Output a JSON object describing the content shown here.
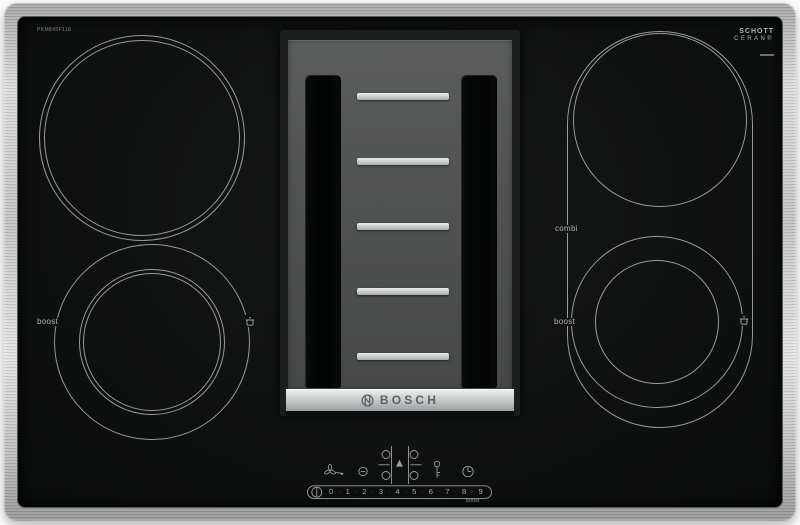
{
  "device": {
    "model_label": "PKM845F11E"
  },
  "branding": {
    "bosch_wordmark": "BOSCH",
    "glass_brand_line1": "SCHOTT",
    "glass_brand_line2": "CERAN®"
  },
  "zone_labels": {
    "left_boost": "boost",
    "combi": "combi",
    "right_boost": "boost"
  },
  "controls": {
    "power_levels": [
      "0",
      "1",
      "2",
      "3",
      "4",
      "5",
      "6",
      "7",
      "8",
      "9"
    ],
    "level_separator": "·",
    "boost_label": "boost",
    "icon_names": [
      "fan-icon",
      "vent-level-icon",
      "zone-select-icon",
      "child-lock-icon",
      "timer-icon",
      "power-icon",
      "pan-marker-icon",
      "bosch-anchor-icon"
    ]
  },
  "colors": {
    "frame_steel": "#c6c9ca",
    "glass": "#121313",
    "ring_line": "#cecece",
    "module_face": "#525353",
    "module_slot": "#070808",
    "grill_bar": "#d6d9d9",
    "brand_strip": "#c2c5c6",
    "control_print": "#9ba0a1"
  }
}
